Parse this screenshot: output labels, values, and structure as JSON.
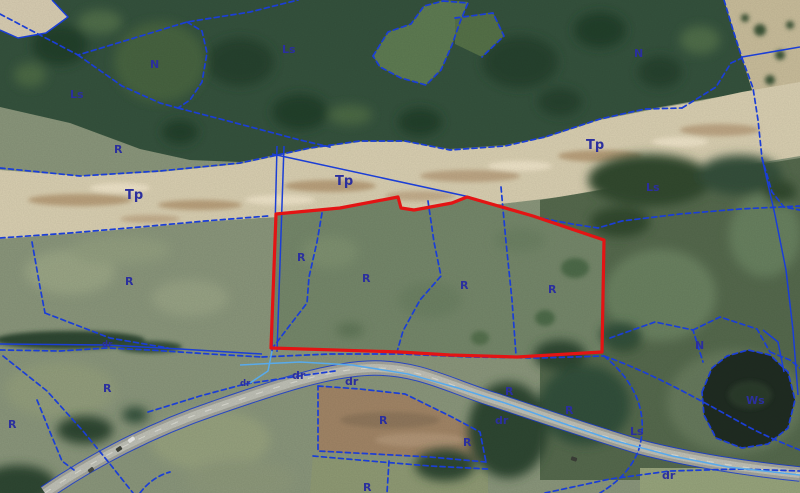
{
  "map": {
    "highlighted_parcel": {
      "outline_color": "#e31414",
      "land_use_labels_inside": [
        "R",
        "R",
        "R",
        "R"
      ]
    },
    "land_use_labels": [
      {
        "text": "Ls",
        "x": 70,
        "y": 98,
        "size": "md"
      },
      {
        "text": "N",
        "x": 150,
        "y": 68,
        "size": "md"
      },
      {
        "text": "R",
        "x": 114,
        "y": 153,
        "size": "md"
      },
      {
        "text": "Ls",
        "x": 282,
        "y": 53,
        "size": "md"
      },
      {
        "text": "N",
        "x": 634,
        "y": 57,
        "size": "md"
      },
      {
        "text": "Tp",
        "x": 586,
        "y": 149,
        "size": "lg"
      },
      {
        "text": "Tp",
        "x": 125,
        "y": 199,
        "size": "lg"
      },
      {
        "text": "Tp",
        "x": 335,
        "y": 185,
        "size": "lg"
      },
      {
        "text": "Ls",
        "x": 646,
        "y": 191,
        "size": "md"
      },
      {
        "text": "R",
        "x": 125,
        "y": 285,
        "size": "md"
      },
      {
        "text": "R",
        "x": 297,
        "y": 261,
        "size": "md"
      },
      {
        "text": "R",
        "x": 362,
        "y": 282,
        "size": "md"
      },
      {
        "text": "R",
        "x": 460,
        "y": 289,
        "size": "md"
      },
      {
        "text": "R",
        "x": 548,
        "y": 293,
        "size": "md"
      },
      {
        "text": "dr",
        "x": 102,
        "y": 347,
        "size": "sm"
      },
      {
        "text": "dr",
        "x": 240,
        "y": 386,
        "size": "sm"
      },
      {
        "text": "dr",
        "x": 292,
        "y": 379,
        "size": "md"
      },
      {
        "text": "dr",
        "x": 345,
        "y": 385,
        "size": "md"
      },
      {
        "text": "R",
        "x": 8,
        "y": 428,
        "size": "md"
      },
      {
        "text": "R",
        "x": 103,
        "y": 392,
        "size": "md"
      },
      {
        "text": "R",
        "x": 379,
        "y": 424,
        "size": "md"
      },
      {
        "text": "R",
        "x": 463,
        "y": 446,
        "size": "md"
      },
      {
        "text": "R",
        "x": 363,
        "y": 491,
        "size": "md"
      },
      {
        "text": "R",
        "x": 505,
        "y": 395,
        "size": "md"
      },
      {
        "text": "dr",
        "x": 495,
        "y": 424,
        "size": "md"
      },
      {
        "text": "R",
        "x": 565,
        "y": 414,
        "size": "md"
      },
      {
        "text": "Ls",
        "x": 630,
        "y": 435,
        "size": "md"
      },
      {
        "text": "dr",
        "x": 662,
        "y": 479,
        "size": "md"
      },
      {
        "text": "N",
        "x": 695,
        "y": 349,
        "size": "md"
      },
      {
        "text": "Ws",
        "x": 746,
        "y": 404,
        "size": "md"
      }
    ]
  },
  "colors": {
    "cadastral_line_blue": "#1b3ed6",
    "utility_line_cyan": "#58aaec",
    "label_navy": "#2b2f9e",
    "parcel_highlight_red": "#e31414"
  }
}
